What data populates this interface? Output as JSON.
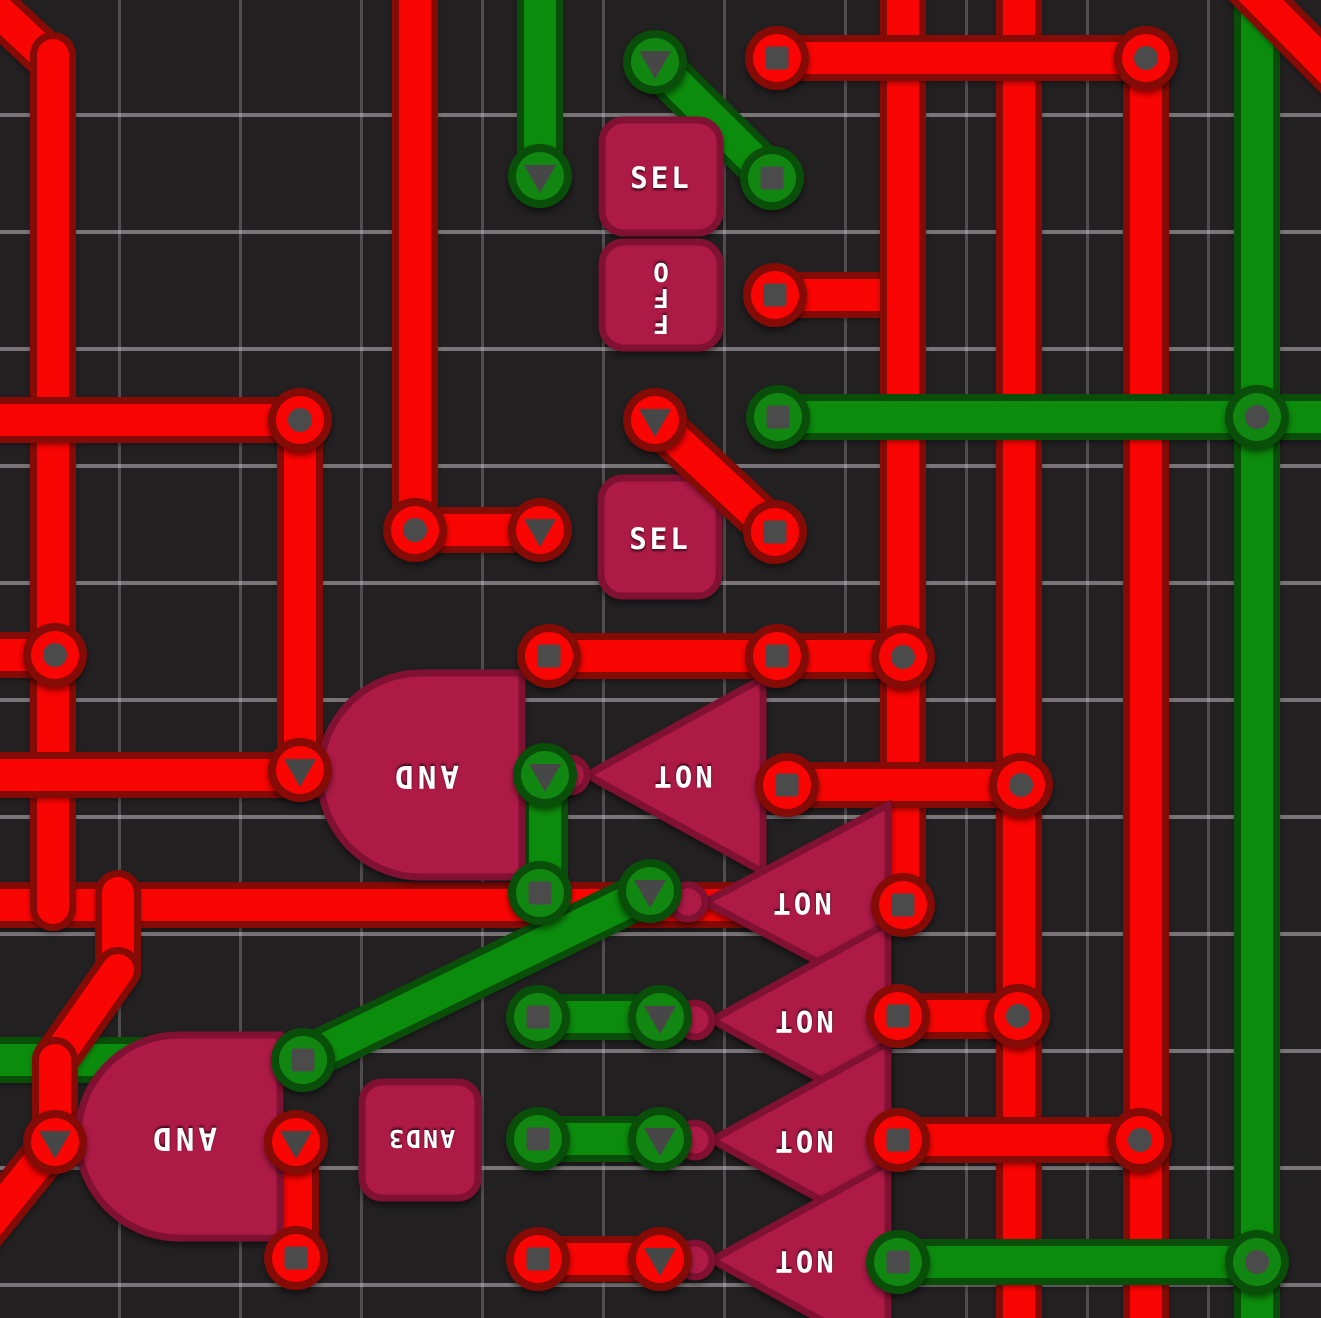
{
  "board": {
    "name": "logic-circuit-board",
    "grid_cell_px": 120,
    "colors": {
      "background": "#232021",
      "grid_line_h": "#8A8488",
      "grid_line_v": "#575257",
      "wire_red_core": "#F90503",
      "wire_red_outline": "#850B06",
      "wire_green_core": "#0C8C0C",
      "wire_green_outline": "#094E09",
      "component_fill": "#AD1A46",
      "component_border": "#801132",
      "pin_gray": "#4B4B4B",
      "label_text": "#FFFFFF"
    }
  },
  "components": {
    "sel1": {
      "label": "SEL"
    },
    "off": {
      "letters": [
        "O",
        "F",
        "F"
      ]
    },
    "sel2": {
      "label": "SEL"
    },
    "and1": {
      "label": "AND"
    },
    "and2": {
      "label": "AND"
    },
    "and3": {
      "label": "AND3"
    },
    "not1": {
      "label": "NOT"
    },
    "not2": {
      "label": "NOT"
    },
    "not3": {
      "label": "NOT"
    },
    "not4": {
      "label": "NOT"
    },
    "not5": {
      "label": "NOT"
    }
  }
}
